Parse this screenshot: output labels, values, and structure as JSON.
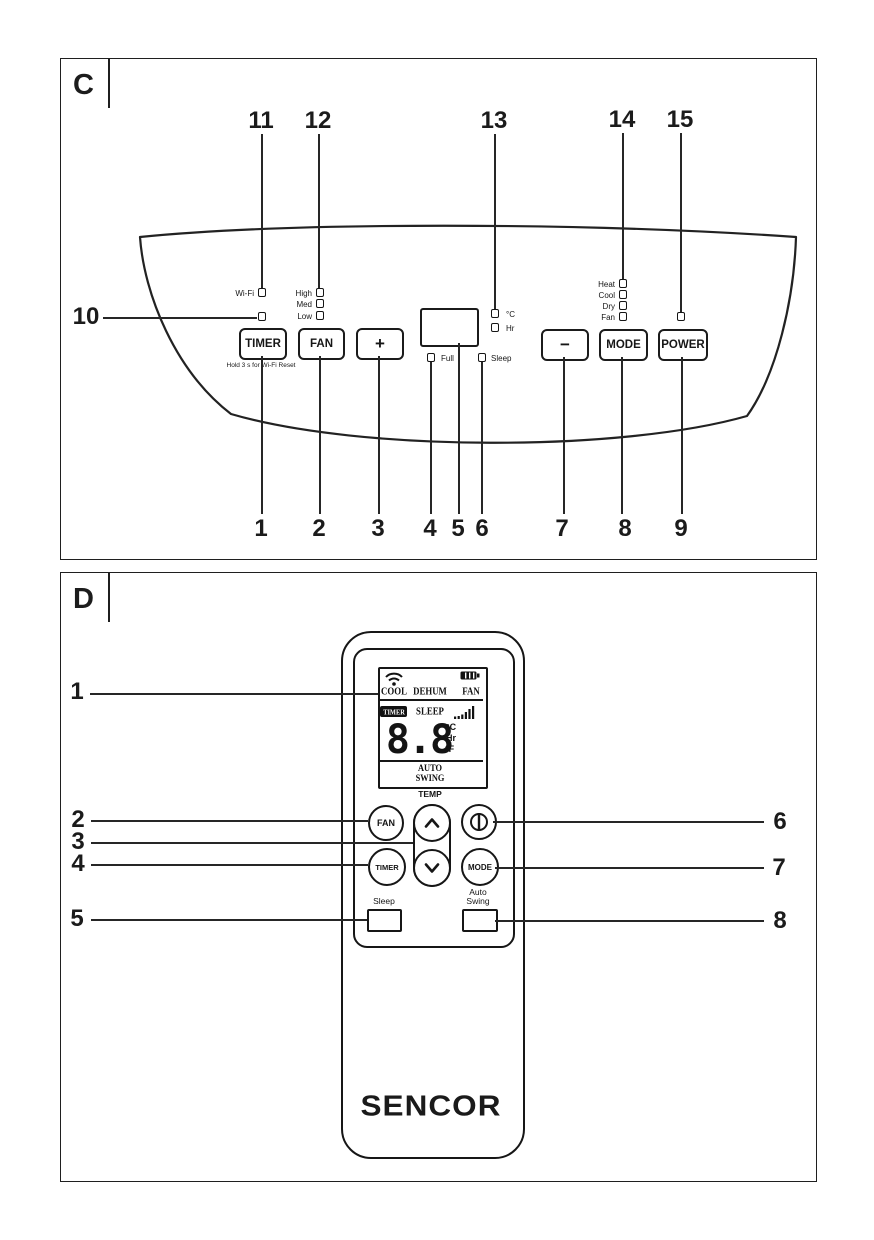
{
  "colors": {
    "ink": "#1c1c1c",
    "bg": "#ffffff"
  },
  "panel_c": {
    "label": "C",
    "top_callouts": [
      "11",
      "12",
      "13",
      "14",
      "15"
    ],
    "left_callout": "10",
    "bottom_callouts": [
      "1",
      "2",
      "3",
      "4",
      "5",
      "6",
      "7",
      "8",
      "9"
    ],
    "leds": {
      "wifi": "Wi-Fi",
      "high": "High",
      "med": "Med",
      "low": "Low",
      "celsius": "°C",
      "hr": "Hr",
      "full": "Full",
      "sleep": "Sleep",
      "heat": "Heat",
      "cool": "Cool",
      "dry": "Dry",
      "fan": "Fan"
    },
    "buttons": {
      "timer": "TIMER",
      "timer_sub": "Hold 3 s for Wi-Fi Reset",
      "fan": "FAN",
      "plus": "+",
      "minus": "−",
      "mode": "MODE",
      "power": "POWER"
    }
  },
  "panel_d": {
    "label": "D",
    "left_callouts": [
      "1",
      "2",
      "3",
      "4",
      "5"
    ],
    "right_callouts": [
      "6",
      "7",
      "8"
    ],
    "lcd": {
      "cool": "COOL",
      "dehum": "DEHUM",
      "fan": "FAN",
      "timer": "TIMER",
      "sleep": "SLEEP",
      "digits": "8.8",
      "unit_c": "°C",
      "unit_hr": "Hr",
      "unit_f": "°F",
      "auto": "AUTO",
      "swing": "SWING"
    },
    "temp_label": "TEMP",
    "buttons": {
      "fan": "FAN",
      "timer": "TIMER",
      "mode": "MODE",
      "sleep": "Sleep",
      "auto": "Auto",
      "swing": "Swing"
    },
    "brand": "SENCOR",
    "icons": {
      "wifi": "wifi-icon",
      "battery": "battery-icon",
      "signal": "signal-bars-icon",
      "power": "power-icon",
      "up": "chevron-up-icon",
      "down": "chevron-down-icon"
    }
  }
}
